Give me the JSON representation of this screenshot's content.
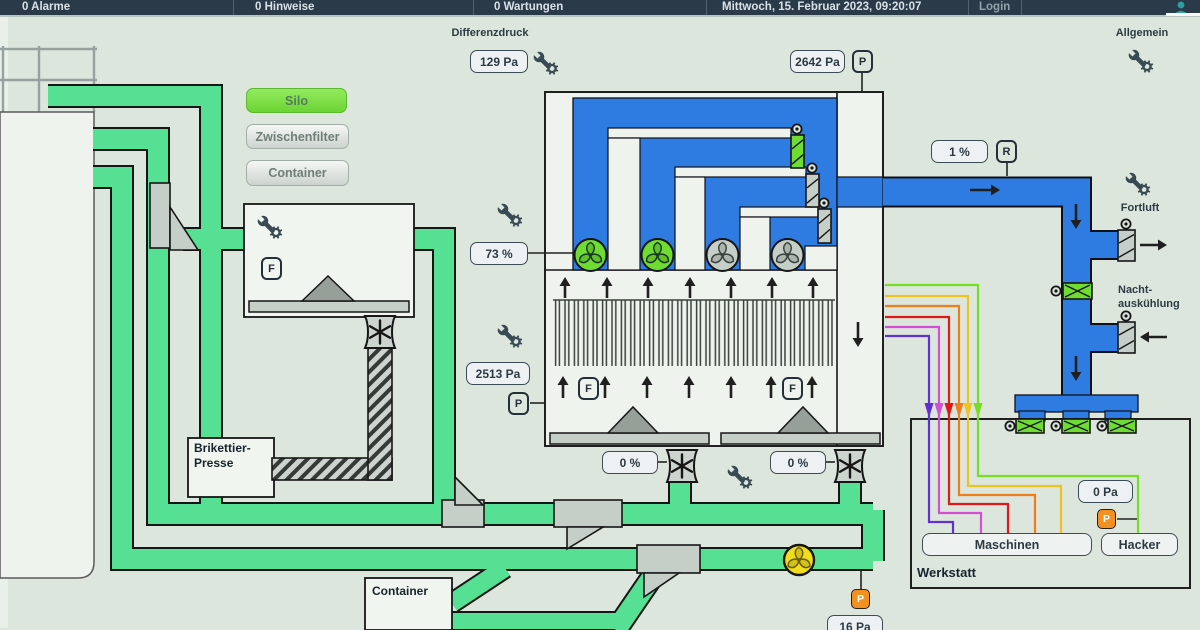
{
  "header": {
    "alarms": "0 Alarme",
    "hints": "0 Hinweise",
    "maintenance": "0 Wartungen",
    "datetime": "Mittwoch, 15. Februar 2023, 09:20:07",
    "login": "Login"
  },
  "nav": {
    "silo": "Silo",
    "zwischenfilter": "Zwischenfilter",
    "container": "Container"
  },
  "labels": {
    "differenzdruck": "Differenzdruck",
    "allgemein": "Allgemein",
    "fortluft": "Fortluft",
    "nacht1": "Nacht-",
    "nacht2": "auskühlung",
    "werkstatt": "Werkstatt",
    "brik1": "Brikettier-",
    "brik2": "Presse",
    "container_box": "Container"
  },
  "buttons": {
    "maschinen": "Maschinen",
    "hacker": "Hacker"
  },
  "values": {
    "filter_diff_pressure": "129 Pa",
    "raw_gas_pressure": "2642 Pa",
    "fan_speed": "73 %",
    "filter_pressure": "2513 Pa",
    "exhaust_damper": "1 %",
    "discharge_left": "0 %",
    "discharge_right": "0 %",
    "werkstatt_pressure": "0 Pa",
    "transport_pressure": "16 Pa"
  },
  "badges": {
    "p": "P",
    "r": "R",
    "f": "F"
  },
  "colors": {
    "pipe_green": "#56e093",
    "duct_blue": "#2e7ce2",
    "active_green": "#6edc30",
    "idle_grey": "#c6cec8",
    "fan_yellow": "#f2dc1e",
    "alert_orange": "#f29022",
    "machine_lines": [
      "#6030d0",
      "#d44fd4",
      "#e01818",
      "#ef7d1a",
      "#edc322",
      "#76df25"
    ]
  }
}
